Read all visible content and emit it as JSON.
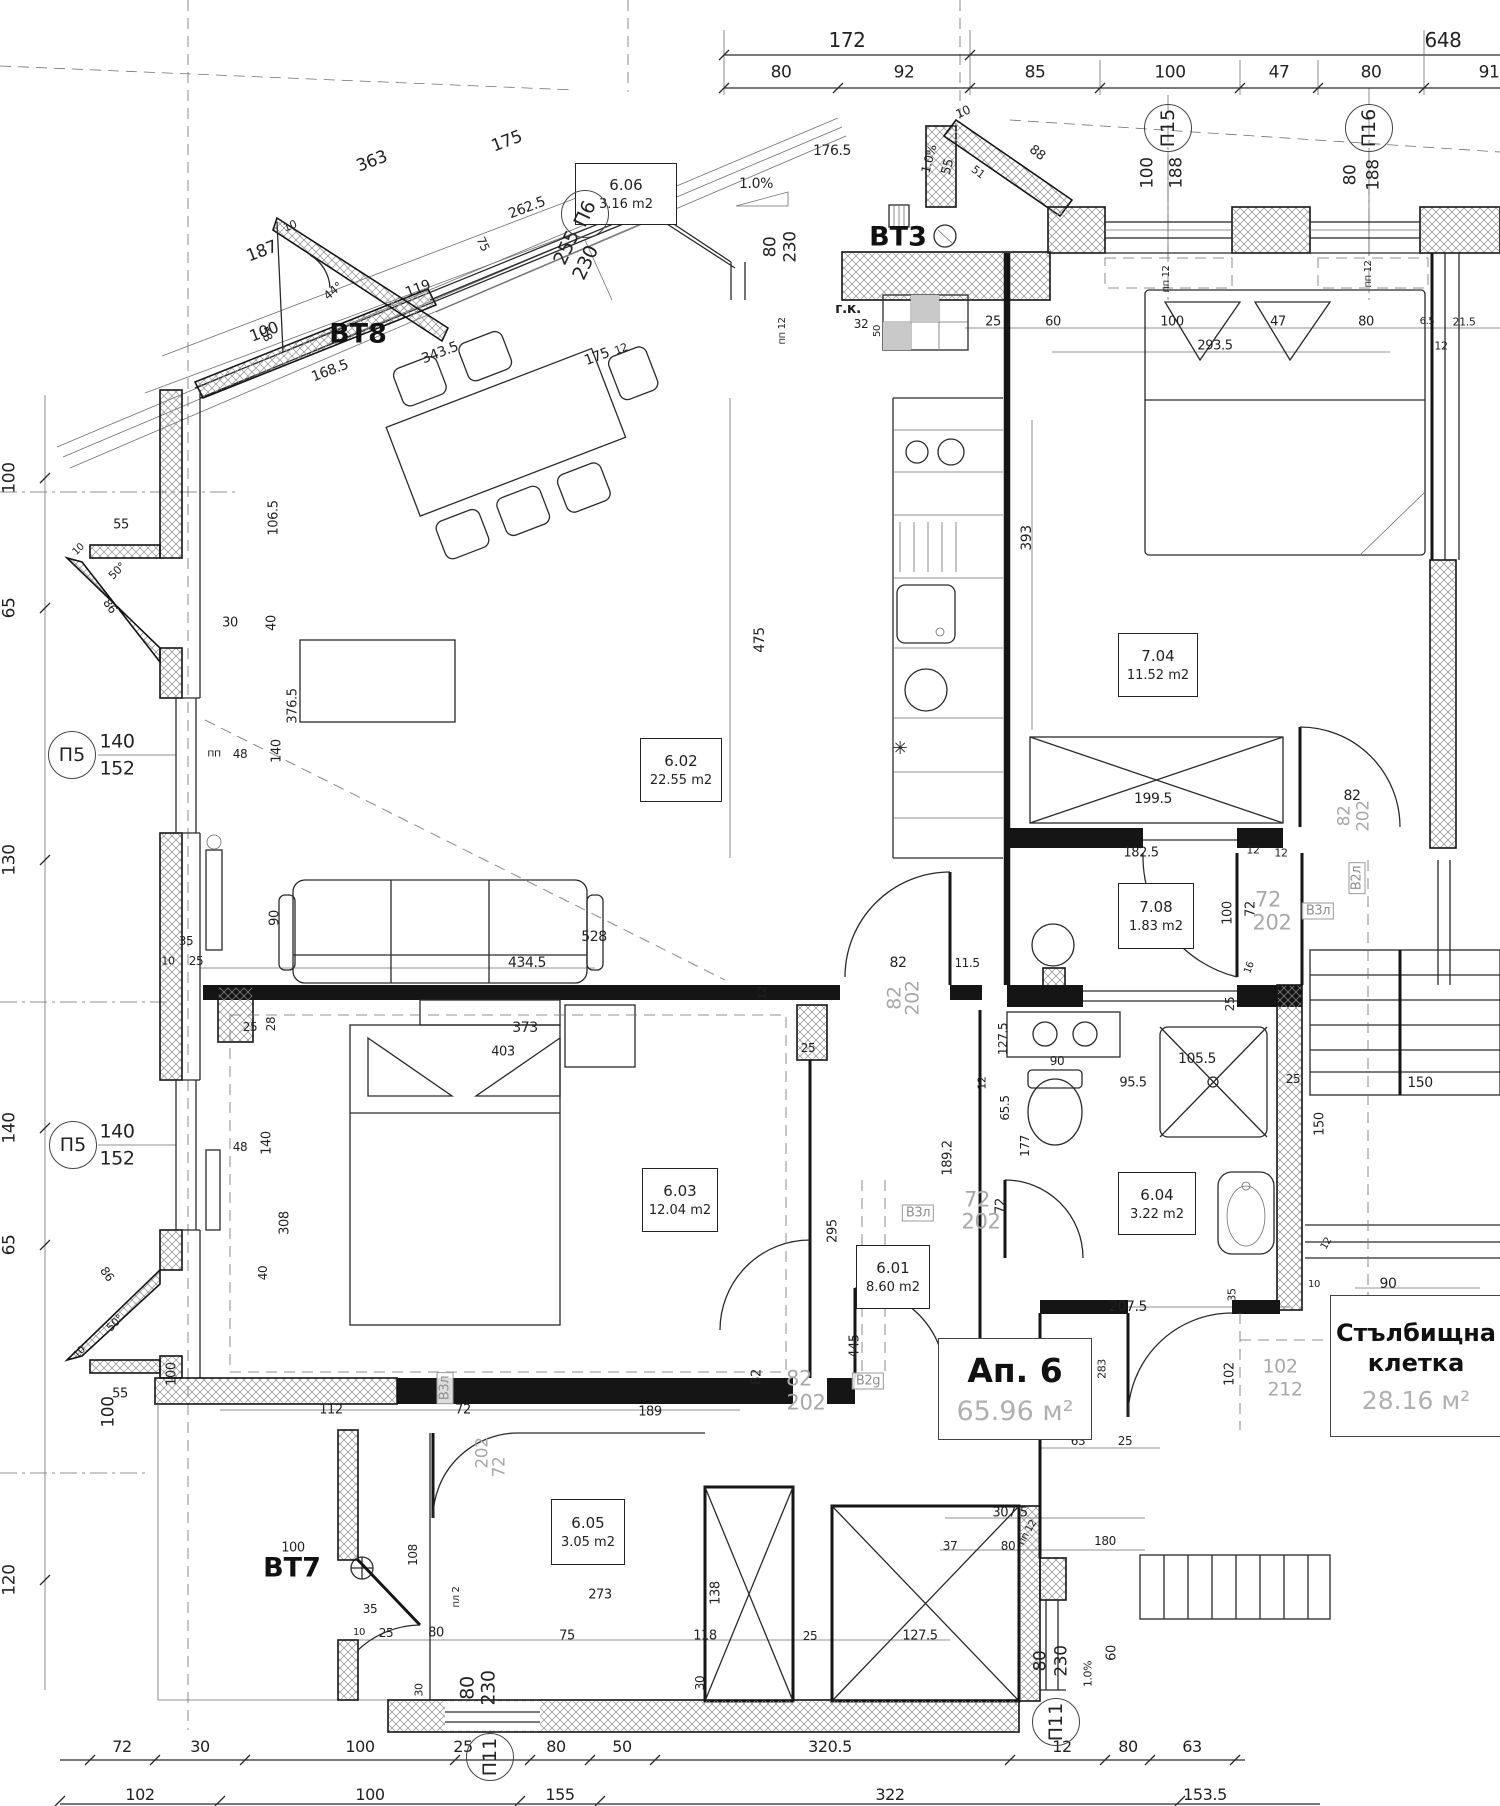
{
  "apartment": {
    "label": "Ап. 6",
    "area": "65.96 м²"
  },
  "stairwell": {
    "label_line1": "Стълбищна",
    "label_line2": "клетка",
    "area": "28.16 м²"
  },
  "rooms": [
    {
      "id": "6.06",
      "area": "3.16 m2",
      "x": 575,
      "y": 163,
      "w": 100,
      "h": 60
    },
    {
      "id": "6.02",
      "area": "22.55 m2",
      "x": 640,
      "y": 738,
      "w": 80,
      "h": 62
    },
    {
      "id": "7.04",
      "area": "11.52 m2",
      "x": 1118,
      "y": 633,
      "w": 78,
      "h": 62
    },
    {
      "id": "7.08",
      "area": "1.83 m2",
      "x": 1118,
      "y": 883,
      "w": 74,
      "h": 64
    },
    {
      "id": "6.03",
      "area": "12.04 m2",
      "x": 642,
      "y": 1168,
      "w": 74,
      "h": 62
    },
    {
      "id": "6.04",
      "area": "3.22 m2",
      "x": 1118,
      "y": 1172,
      "w": 76,
      "h": 61
    },
    {
      "id": "6.01",
      "area": "8.60 m2",
      "x": 856,
      "y": 1245,
      "w": 72,
      "h": 62
    },
    {
      "id": "6.05",
      "area": "3.05 m2",
      "x": 551,
      "y": 1499,
      "w": 72,
      "h": 64
    }
  ],
  "axis_bubbles": [
    {
      "label": "П6",
      "x": 585,
      "y": 214,
      "r": -65
    },
    {
      "label": "П15",
      "x": 1168,
      "y": 128,
      "r": -90
    },
    {
      "label": "П16",
      "x": 1369,
      "y": 128,
      "r": -90
    },
    {
      "label": "П5",
      "x": 72,
      "y": 755,
      "r": 0
    },
    {
      "label": "П5",
      "x": 73,
      "y": 1145,
      "r": 0
    },
    {
      "label": "П11",
      "x": 490,
      "y": 1757,
      "r": -90
    },
    {
      "label": "П11",
      "x": 1056,
      "y": 1722,
      "r": -90
    }
  ],
  "balconies": [
    {
      "label": "BT8",
      "x": 358,
      "y": 334
    },
    {
      "label": "BT3",
      "x": 898,
      "y": 237
    },
    {
      "label": "BT7",
      "x": 292,
      "y": 1568
    }
  ],
  "dims": [
    {
      "t": "172",
      "x": 847,
      "y": 40,
      "s": 20
    },
    {
      "t": "648",
      "x": 1443,
      "y": 40,
      "s": 20
    },
    {
      "t": "80",
      "x": 781,
      "y": 73,
      "s": 17
    },
    {
      "t": "92",
      "x": 904,
      "y": 73,
      "s": 17
    },
    {
      "t": "85",
      "x": 1035,
      "y": 73,
      "s": 17
    },
    {
      "t": "100",
      "x": 1170,
      "y": 73,
      "s": 17
    },
    {
      "t": "47",
      "x": 1279,
      "y": 73,
      "s": 17
    },
    {
      "t": "80",
      "x": 1371,
      "y": 73,
      "s": 17
    },
    {
      "t": "91",
      "x": 1489,
      "y": 73,
      "s": 17
    },
    {
      "t": "363",
      "x": 372,
      "y": 162,
      "r": -21,
      "s": 17
    },
    {
      "t": "175",
      "x": 507,
      "y": 142,
      "r": -21,
      "s": 17
    },
    {
      "t": "262.5",
      "x": 527,
      "y": 208,
      "r": -21
    },
    {
      "t": "187",
      "x": 262,
      "y": 252,
      "r": -21,
      "s": 17
    },
    {
      "t": "10",
      "x": 290,
      "y": 226,
      "r": -21,
      "s": 11
    },
    {
      "t": "119",
      "x": 418,
      "y": 289,
      "r": -21
    },
    {
      "t": "100",
      "x": 264,
      "y": 332,
      "r": -21,
      "s": 16
    },
    {
      "t": "343.5",
      "x": 440,
      "y": 353,
      "r": -21
    },
    {
      "t": "168.5",
      "x": 330,
      "y": 371,
      "r": -21
    },
    {
      "t": "175",
      "x": 597,
      "y": 357,
      "r": -21
    },
    {
      "t": "12",
      "x": 621,
      "y": 349,
      "r": -21,
      "s": 11
    },
    {
      "t": "44°",
      "x": 333,
      "y": 291,
      "r": -40,
      "s": 12
    },
    {
      "t": "58",
      "x": 266,
      "y": 334,
      "r": 65,
      "s": 12
    },
    {
      "t": "75",
      "x": 483,
      "y": 244,
      "r": 65,
      "s": 12
    },
    {
      "t": "106.5",
      "x": 274,
      "y": 518,
      "r": -90,
      "s": 13
    },
    {
      "t": "376.5",
      "x": 293,
      "y": 706,
      "r": -90,
      "s": 13
    },
    {
      "t": "255",
      "x": 567,
      "y": 248,
      "r": -65,
      "s": 19
    },
    {
      "t": "230",
      "x": 586,
      "y": 263,
      "r": -65,
      "s": 19
    },
    {
      "t": "176.5",
      "x": 832,
      "y": 151
    },
    {
      "t": "1.0%",
      "x": 929,
      "y": 159,
      "r": -75,
      "s": 12
    },
    {
      "t": "55",
      "x": 948,
      "y": 167,
      "r": -75,
      "s": 13
    },
    {
      "t": "10",
      "x": 963,
      "y": 112,
      "r": -25,
      "s": 12
    },
    {
      "t": "88",
      "x": 1037,
      "y": 153,
      "r": 38,
      "s": 13
    },
    {
      "t": "51",
      "x": 978,
      "y": 172,
      "r": 38,
      "s": 11
    },
    {
      "t": "1.0%",
      "x": 756,
      "y": 184,
      "s": 14
    },
    {
      "t": "г.к.",
      "x": 848,
      "y": 309,
      "s": 14,
      "c": "bb"
    },
    {
      "t": "32",
      "x": 861,
      "y": 324,
      "s": 12
    },
    {
      "t": "50",
      "x": 878,
      "y": 331,
      "r": -90,
      "s": 10
    },
    {
      "t": "25",
      "x": 993,
      "y": 322,
      "s": 13
    },
    {
      "t": "60",
      "x": 1053,
      "y": 322,
      "s": 13
    },
    {
      "t": "100",
      "x": 1172,
      "y": 322,
      "s": 13
    },
    {
      "t": "47",
      "x": 1278,
      "y": 322,
      "s": 13
    },
    {
      "t": "80",
      "x": 1366,
      "y": 322,
      "s": 13
    },
    {
      "t": "293.5",
      "x": 1215,
      "y": 346,
      "s": 13
    },
    {
      "t": "6.5",
      "x": 1427,
      "y": 322,
      "s": 10
    },
    {
      "t": "21.5",
      "x": 1464,
      "y": 322,
      "s": 11
    },
    {
      "t": "12",
      "x": 1441,
      "y": 346,
      "s": 11
    },
    {
      "t": "80",
      "x": 771,
      "y": 247,
      "r": -90,
      "s": 17
    },
    {
      "t": "230",
      "x": 791,
      "y": 247,
      "r": -90,
      "s": 17
    },
    {
      "t": "пп 12",
      "x": 783,
      "y": 331,
      "r": -90,
      "s": 10
    },
    {
      "t": "100",
      "x": 1148,
      "y": 173,
      "r": -90,
      "s": 17
    },
    {
      "t": "188",
      "x": 1177,
      "y": 173,
      "r": -90,
      "s": 17
    },
    {
      "t": "пп 12",
      "x": 1167,
      "y": 279,
      "r": -90,
      "s": 10
    },
    {
      "t": "80",
      "x": 1351,
      "y": 175,
      "r": -90,
      "s": 17
    },
    {
      "t": "188",
      "x": 1374,
      "y": 175,
      "r": -90,
      "s": 17
    },
    {
      "t": "пп 12",
      "x": 1369,
      "y": 274,
      "r": -90,
      "s": 10
    },
    {
      "t": "100",
      "x": 10,
      "y": 478,
      "r": -90,
      "s": 17
    },
    {
      "t": "65",
      "x": 10,
      "y": 608,
      "r": -90,
      "s": 17
    },
    {
      "t": "130",
      "x": 10,
      "y": 860,
      "r": -90,
      "s": 17
    },
    {
      "t": "140",
      "x": 10,
      "y": 1128,
      "r": -90,
      "s": 17
    },
    {
      "t": "65",
      "x": 10,
      "y": 1245,
      "r": -90,
      "s": 17
    },
    {
      "t": "100",
      "x": 109,
      "y": 1412,
      "r": -90,
      "s": 17
    },
    {
      "t": "120",
      "x": 10,
      "y": 1580,
      "r": -90,
      "s": 17
    },
    {
      "t": "140",
      "x": 117,
      "y": 742,
      "s": 19
    },
    {
      "t": "152",
      "x": 117,
      "y": 769,
      "s": 19
    },
    {
      "t": "пп",
      "x": 214,
      "y": 753,
      "s": 11
    },
    {
      "t": "48",
      "x": 240,
      "y": 754,
      "s": 12
    },
    {
      "t": "140",
      "x": 277,
      "y": 751,
      "r": -90,
      "s": 13
    },
    {
      "t": "30",
      "x": 230,
      "y": 623,
      "s": 13
    },
    {
      "t": "40",
      "x": 272,
      "y": 623,
      "r": -90,
      "s": 13
    },
    {
      "t": "50°",
      "x": 117,
      "y": 571,
      "r": -45,
      "s": 11
    },
    {
      "t": "86",
      "x": 110,
      "y": 606,
      "r": 55,
      "s": 12
    },
    {
      "t": "55",
      "x": 121,
      "y": 525,
      "s": 13
    },
    {
      "t": "10",
      "x": 79,
      "y": 550,
      "r": -45,
      "s": 10
    },
    {
      "t": "140",
      "x": 117,
      "y": 1132,
      "s": 19
    },
    {
      "t": "152",
      "x": 117,
      "y": 1159,
      "s": 19
    },
    {
      "t": "48",
      "x": 240,
      "y": 1147,
      "s": 12
    },
    {
      "t": "140",
      "x": 267,
      "y": 1143,
      "r": -90,
      "s": 13
    },
    {
      "t": "308",
      "x": 285,
      "y": 1223,
      "r": -90,
      "s": 13
    },
    {
      "t": "40",
      "x": 263,
      "y": 1273,
      "r": -90,
      "s": 12
    },
    {
      "t": "86",
      "x": 107,
      "y": 1274,
      "r": 55,
      "s": 12
    },
    {
      "t": "50°",
      "x": 115,
      "y": 1323,
      "r": -45,
      "s": 11
    },
    {
      "t": "55",
      "x": 120,
      "y": 1394,
      "s": 13
    },
    {
      "t": "10",
      "x": 80,
      "y": 1353,
      "r": -45,
      "s": 10
    },
    {
      "t": "475",
      "x": 760,
      "y": 640,
      "r": -90
    },
    {
      "t": "393",
      "x": 1027,
      "y": 538,
      "r": -90
    },
    {
      "t": "90",
      "x": 275,
      "y": 918,
      "r": -90,
      "s": 13
    },
    {
      "t": "35",
      "x": 186,
      "y": 941,
      "s": 12
    },
    {
      "t": "10",
      "x": 168,
      "y": 961,
      "s": 11
    },
    {
      "t": "25",
      "x": 196,
      "y": 961,
      "s": 12
    },
    {
      "t": "434.5",
      "x": 527,
      "y": 963
    },
    {
      "t": "528",
      "x": 594,
      "y": 937
    },
    {
      "t": "12",
      "x": 762,
      "y": 993,
      "r": -90,
      "s": 11
    },
    {
      "t": "82",
      "x": 898,
      "y": 963
    },
    {
      "t": "11.5",
      "x": 967,
      "y": 963,
      "s": 12
    },
    {
      "t": "82",
      "x": 895,
      "y": 998,
      "r": -90,
      "s": 19,
      "c": "g"
    },
    {
      "t": "202",
      "x": 913,
      "y": 998,
      "r": -90,
      "s": 19,
      "c": "g"
    },
    {
      "t": "25",
      "x": 808,
      "y": 1048,
      "s": 12
    },
    {
      "t": "25",
      "x": 250,
      "y": 1027,
      "s": 12
    },
    {
      "t": "28",
      "x": 271,
      "y": 1024,
      "r": -90,
      "s": 12
    },
    {
      "t": "✳",
      "x": 900,
      "y": 749,
      "s": 18
    },
    {
      "t": "373",
      "x": 525,
      "y": 1028
    },
    {
      "t": "403",
      "x": 503,
      "y": 1052,
      "s": 13
    },
    {
      "t": "199.5",
      "x": 1153,
      "y": 799
    },
    {
      "t": "182.5",
      "x": 1141,
      "y": 853,
      "s": 13
    },
    {
      "t": "12",
      "x": 1253,
      "y": 850,
      "s": 11
    },
    {
      "t": "12",
      "x": 1281,
      "y": 853,
      "s": 11
    },
    {
      "t": "82",
      "x": 1352,
      "y": 796
    },
    {
      "t": "82",
      "x": 1345,
      "y": 816,
      "r": -90,
      "s": 17,
      "c": "g"
    },
    {
      "t": "202",
      "x": 1364,
      "y": 816,
      "r": -90,
      "s": 17,
      "c": "g"
    },
    {
      "t": "100",
      "x": 1228,
      "y": 913,
      "r": -90,
      "s": 13
    },
    {
      "t": "72",
      "x": 1251,
      "y": 909,
      "r": -90,
      "s": 13
    },
    {
      "t": "72",
      "x": 1268,
      "y": 900,
      "s": 21,
      "c": "g"
    },
    {
      "t": "202",
      "x": 1272,
      "y": 923,
      "s": 21,
      "c": "g"
    },
    {
      "t": "16",
      "x": 1250,
      "y": 968,
      "r": -70,
      "s": 10
    },
    {
      "t": "25",
      "x": 1230,
      "y": 1004,
      "r": -90,
      "s": 12
    },
    {
      "t": "127.5",
      "x": 1003,
      "y": 1039,
      "r": -90,
      "s": 12
    },
    {
      "t": "90",
      "x": 1057,
      "y": 1061,
      "s": 12
    },
    {
      "t": "12",
      "x": 982,
      "y": 1083,
      "r": -90,
      "s": 11
    },
    {
      "t": "65.5",
      "x": 1005,
      "y": 1108,
      "r": -90,
      "s": 12
    },
    {
      "t": "177",
      "x": 1025,
      "y": 1146,
      "r": -90,
      "s": 12
    },
    {
      "t": "95.5",
      "x": 1133,
      "y": 1083,
      "s": 13
    },
    {
      "t": "105.5",
      "x": 1197,
      "y": 1059
    },
    {
      "t": "25",
      "x": 1293,
      "y": 1079,
      "s": 12
    },
    {
      "t": "150",
      "x": 1420,
      "y": 1083
    },
    {
      "t": "150",
      "x": 1320,
      "y": 1124,
      "r": -90,
      "s": 13
    },
    {
      "t": "207.5",
      "x": 1128,
      "y": 1307
    },
    {
      "t": "35",
      "x": 1232,
      "y": 1295,
      "r": -90,
      "s": 11
    },
    {
      "t": "12",
      "x": 1327,
      "y": 1244,
      "r": -60,
      "s": 10
    },
    {
      "t": "10",
      "x": 1314,
      "y": 1285,
      "s": 10
    },
    {
      "t": "90",
      "x": 1388,
      "y": 1284
    },
    {
      "t": "176",
      "x": 1435,
      "y": 1304
    },
    {
      "t": "189.2",
      "x": 948,
      "y": 1158,
      "r": -90,
      "s": 13
    },
    {
      "t": "295",
      "x": 833,
      "y": 1231,
      "r": -90,
      "s": 13
    },
    {
      "t": "72",
      "x": 977,
      "y": 1200,
      "s": 21,
      "c": "g"
    },
    {
      "t": "202",
      "x": 981,
      "y": 1222,
      "s": 21,
      "c": "g"
    },
    {
      "t": "72",
      "x": 1001,
      "y": 1206,
      "r": -90,
      "s": 13
    },
    {
      "t": "445",
      "x": 855,
      "y": 1346,
      "r": -90,
      "s": 13
    },
    {
      "t": "195.5",
      "x": 1050,
      "y": 1406,
      "r": -90,
      "s": 12
    },
    {
      "t": "283",
      "x": 1102,
      "y": 1369,
      "r": -90,
      "s": 11
    },
    {
      "t": "63",
      "x": 1078,
      "y": 1441,
      "s": 12
    },
    {
      "t": "25",
      "x": 1125,
      "y": 1441,
      "s": 12
    },
    {
      "t": "102",
      "x": 1230,
      "y": 1374,
      "r": -90,
      "s": 13
    },
    {
      "t": "102",
      "x": 1280,
      "y": 1367,
      "s": 19,
      "c": "g"
    },
    {
      "t": "212",
      "x": 1285,
      "y": 1390,
      "s": 19,
      "c": "g"
    },
    {
      "t": "112",
      "x": 331,
      "y": 1410,
      "s": 13
    },
    {
      "t": "72",
      "x": 463,
      "y": 1410,
      "s": 13
    },
    {
      "t": "189",
      "x": 650,
      "y": 1412,
      "s": 13
    },
    {
      "t": "202",
      "x": 483,
      "y": 1453,
      "r": -90,
      "s": 17,
      "c": "g"
    },
    {
      "t": "72",
      "x": 500,
      "y": 1467,
      "r": -90,
      "s": 17,
      "c": "g"
    },
    {
      "t": "82",
      "x": 757,
      "y": 1377,
      "r": -90,
      "s": 13
    },
    {
      "t": "82",
      "x": 799,
      "y": 1379,
      "s": 21,
      "c": "g"
    },
    {
      "t": "202",
      "x": 806,
      "y": 1403,
      "s": 21,
      "c": "g"
    },
    {
      "t": "100",
      "x": 172,
      "y": 1374,
      "r": -90,
      "s": 13
    },
    {
      "t": "100",
      "x": 293,
      "y": 1548,
      "s": 13
    },
    {
      "t": "108",
      "x": 413,
      "y": 1555,
      "r": -90,
      "s": 12
    },
    {
      "t": "пл 2",
      "x": 457,
      "y": 1597,
      "r": -90,
      "s": 10
    },
    {
      "t": "35",
      "x": 370,
      "y": 1609,
      "s": 12
    },
    {
      "t": "10",
      "x": 359,
      "y": 1633,
      "s": 10
    },
    {
      "t": "25",
      "x": 386,
      "y": 1633,
      "s": 12
    },
    {
      "t": "80",
      "x": 436,
      "y": 1633,
      "s": 13
    },
    {
      "t": "273",
      "x": 600,
      "y": 1595,
      "s": 13
    },
    {
      "t": "75",
      "x": 567,
      "y": 1636,
      "s": 13
    },
    {
      "t": "118",
      "x": 705,
      "y": 1636,
      "s": 13
    },
    {
      "t": "25",
      "x": 810,
      "y": 1636,
      "s": 12
    },
    {
      "t": "127.5",
      "x": 920,
      "y": 1636,
      "s": 13
    },
    {
      "t": "138",
      "x": 716,
      "y": 1593,
      "r": -90,
      "s": 13
    },
    {
      "t": "30",
      "x": 700,
      "y": 1683,
      "r": -90,
      "s": 12
    },
    {
      "t": "30",
      "x": 419,
      "y": 1690,
      "r": -90,
      "s": 11
    },
    {
      "t": "80",
      "x": 468,
      "y": 1688,
      "r": -90,
      "s": 19
    },
    {
      "t": "230",
      "x": 489,
      "y": 1688,
      "r": -90,
      "s": 19
    },
    {
      "t": "307.5",
      "x": 1010,
      "y": 1513,
      "s": 13
    },
    {
      "t": "37",
      "x": 950,
      "y": 1546,
      "s": 12
    },
    {
      "t": "80",
      "x": 1008,
      "y": 1546,
      "s": 12
    },
    {
      "t": "пп 12",
      "x": 1028,
      "y": 1533,
      "r": -60,
      "s": 10
    },
    {
      "t": "180",
      "x": 1105,
      "y": 1541,
      "s": 12
    },
    {
      "t": "80",
      "x": 1041,
      "y": 1661,
      "r": -90,
      "s": 17
    },
    {
      "t": "230",
      "x": 1062,
      "y": 1661,
      "r": -90,
      "s": 17
    },
    {
      "t": "1.0%",
      "x": 1088,
      "y": 1674,
      "r": -90,
      "s": 11
    },
    {
      "t": "60",
      "x": 1112,
      "y": 1653,
      "r": -90,
      "s": 13
    },
    {
      "t": "72",
      "x": 122,
      "y": 1747,
      "s": 16
    },
    {
      "t": "30",
      "x": 200,
      "y": 1747,
      "s": 16
    },
    {
      "t": "100",
      "x": 360,
      "y": 1747,
      "s": 16
    },
    {
      "t": "25",
      "x": 463,
      "y": 1747,
      "s": 16
    },
    {
      "t": "80",
      "x": 556,
      "y": 1747,
      "s": 16
    },
    {
      "t": "50",
      "x": 622,
      "y": 1747,
      "s": 16
    },
    {
      "t": "320.5",
      "x": 830,
      "y": 1747,
      "s": 16
    },
    {
      "t": "12",
      "x": 1062,
      "y": 1747,
      "s": 16
    },
    {
      "t": "80",
      "x": 1128,
      "y": 1747,
      "s": 16
    },
    {
      "t": "63",
      "x": 1192,
      "y": 1747,
      "s": 16
    },
    {
      "t": "102",
      "x": 140,
      "y": 1795,
      "s": 16
    },
    {
      "t": "100",
      "x": 370,
      "y": 1795,
      "s": 16
    },
    {
      "t": "155",
      "x": 560,
      "y": 1795,
      "s": 16
    },
    {
      "t": "322",
      "x": 890,
      "y": 1795,
      "s": 16
    },
    {
      "t": "153.5",
      "x": 1205,
      "y": 1795,
      "s": 16
    },
    {
      "t": "B2л",
      "x": 1357,
      "y": 878,
      "r": -90,
      "s": 13,
      "c": "gb"
    },
    {
      "t": "B3л",
      "x": 1318,
      "y": 911,
      "s": 13,
      "c": "gb"
    },
    {
      "t": "B3л",
      "x": 918,
      "y": 1213,
      "s": 13,
      "c": "gb"
    },
    {
      "t": "B3л",
      "x": 445,
      "y": 1388,
      "r": -90,
      "s": 13,
      "c": "gb"
    },
    {
      "t": "B1л",
      "x": 1347,
      "y": 1372,
      "s": 13,
      "c": "gb"
    },
    {
      "t": "B2g",
      "x": 868,
      "y": 1381,
      "s": 13,
      "c": "gb"
    }
  ]
}
